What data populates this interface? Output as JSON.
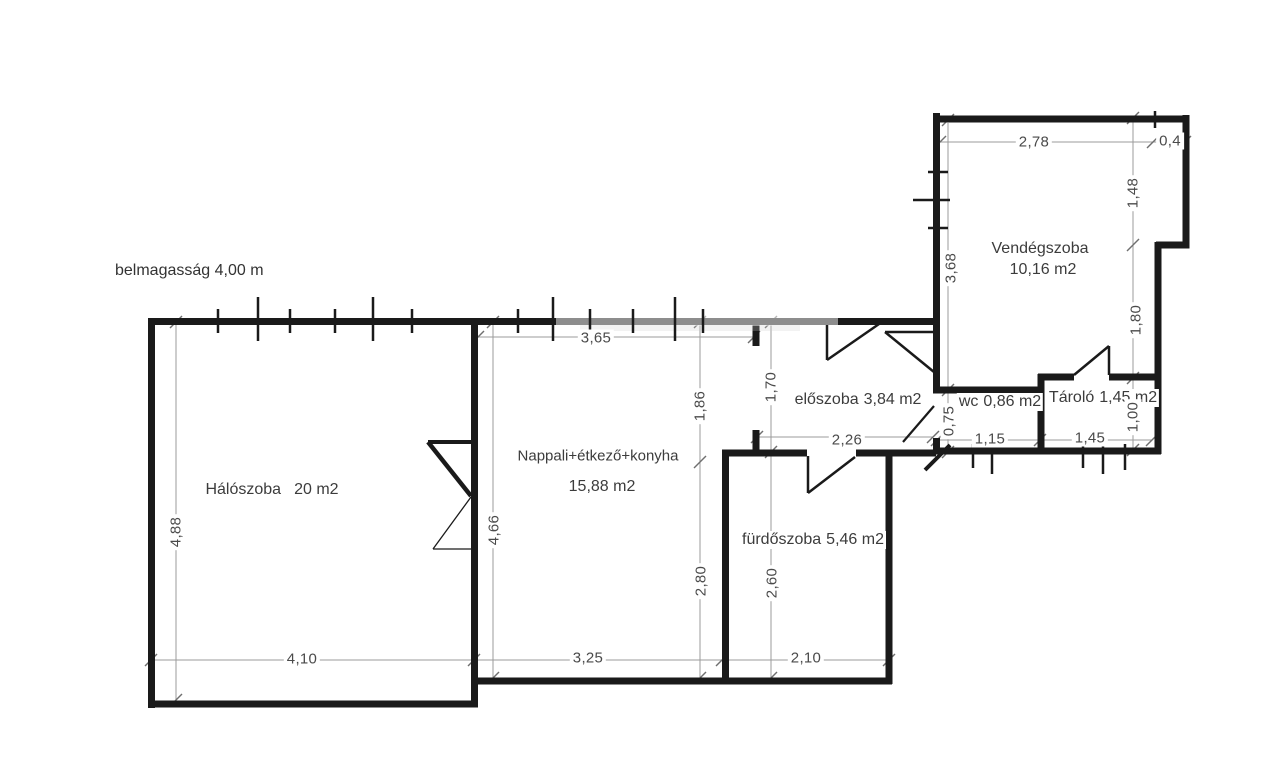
{
  "note": {
    "text": "belmagasság 4,00 m"
  },
  "rooms": [
    {
      "id": "haloszoba",
      "name": "Hálószoba",
      "area": "20 m2"
    },
    {
      "id": "nappali",
      "name": "Nappali+étkező+konyha",
      "area": "15,88 m2"
    },
    {
      "id": "furdoszoba",
      "name": "fürdőszoba",
      "area": "5,46 m2"
    },
    {
      "id": "eloszoba",
      "name": "előszoba",
      "area": "3,84 m2"
    },
    {
      "id": "wc",
      "name": "wc",
      "area": "0,86 m2"
    },
    {
      "id": "tarolo",
      "name": "Tároló",
      "area": "1,45 m2"
    },
    {
      "id": "vendegszoba",
      "name": "Vendégszoba",
      "area": "10,16 m2"
    }
  ],
  "dimensions": [
    {
      "id": "halo-height",
      "value": "4,88"
    },
    {
      "id": "halo-width",
      "value": "4,10"
    },
    {
      "id": "nappali-top-width",
      "value": "3,65"
    },
    {
      "id": "nappali-height",
      "value": "4,66"
    },
    {
      "id": "nappali-upper-height",
      "value": "1,86"
    },
    {
      "id": "nappali-lower-height",
      "value": "2,80"
    },
    {
      "id": "nappali-bottom-width",
      "value": "3,25"
    },
    {
      "id": "eloszoba-height",
      "value": "1,70"
    },
    {
      "id": "eloszoba-width",
      "value": "2,26"
    },
    {
      "id": "furdo-height",
      "value": "2,60"
    },
    {
      "id": "furdo-width",
      "value": "2,10"
    },
    {
      "id": "wc-height",
      "value": "0,75"
    },
    {
      "id": "wc-width",
      "value": "1,15"
    },
    {
      "id": "tarolo-width",
      "value": "1,45"
    },
    {
      "id": "tarolo-height",
      "value": "1,00"
    },
    {
      "id": "vendeg-top-width",
      "value": "2,78"
    },
    {
      "id": "vendeg-notch-width",
      "value": "0,4"
    },
    {
      "id": "vendeg-right-upper",
      "value": "1,48"
    },
    {
      "id": "vendeg-right-lower",
      "value": "1,80"
    },
    {
      "id": "vendeg-left-height",
      "value": "3,68"
    }
  ]
}
